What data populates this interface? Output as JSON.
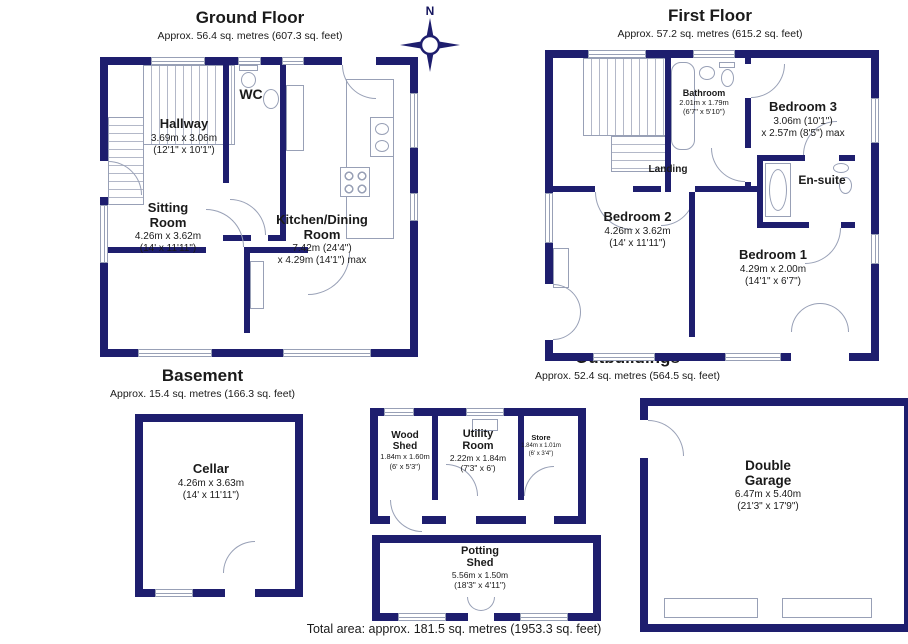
{
  "colors": {
    "wall": "#1e1e6e",
    "fixture": "#98a0b6",
    "text": "#1a1a1a"
  },
  "compass": {
    "label": "N"
  },
  "total_area": "Total area: approx. 181.5 sq. metres (1953.3 sq. feet)",
  "floors": {
    "ground": {
      "title": "Ground Floor",
      "subtitle": "Approx. 56.4 sq. metres (607.3 sq. feet)",
      "rooms": {
        "hallway": {
          "name": "Hallway",
          "metric": "3.69m x 3.06m",
          "imperial": "(12'1\" x 10'1\")"
        },
        "wc": {
          "name": "WC"
        },
        "sitting_room": {
          "name": "Sitting Room",
          "metric": "4.26m x 3.62m",
          "imperial": "(14' x 11'11\")"
        },
        "kitchen_dining": {
          "name": "Kitchen/Dining Room",
          "metric": "7.42m (24'4\")",
          "imperial": "x 4.29m (14'1\") max"
        }
      }
    },
    "first": {
      "title": "First Floor",
      "subtitle": "Approx. 57.2 sq. metres (615.2 sq. feet)",
      "rooms": {
        "bathroom": {
          "name": "Bathroom",
          "metric": "2.01m x 1.79m",
          "imperial": "(6'7\" x 5'10\")"
        },
        "bedroom3": {
          "name": "Bedroom 3",
          "metric": "3.06m (10'1\")",
          "imperial": "x 2.57m (8'5\") max"
        },
        "landing": {
          "name": "Landing"
        },
        "bedroom2": {
          "name": "Bedroom 2",
          "metric": "4.26m x 3.62m",
          "imperial": "(14' x 11'11\")"
        },
        "ensuite": {
          "name": "En-suite"
        },
        "bedroom1": {
          "name": "Bedroom 1",
          "metric": "4.29m x 2.00m",
          "imperial": "(14'1\" x 6'7\")"
        }
      }
    },
    "basement": {
      "title": "Basement",
      "subtitle": "Approx. 15.4 sq. metres (166.3 sq. feet)",
      "rooms": {
        "cellar": {
          "name": "Cellar",
          "metric": "4.26m x 3.63m",
          "imperial": "(14' x 11'11\")"
        }
      }
    },
    "outbuildings": {
      "title": "Outbuildings",
      "subtitle": "Approx. 52.4 sq. metres (564.5 sq. feet)",
      "rooms": {
        "wood_shed": {
          "name": "Wood Shed",
          "metric": "1.84m x 1.60m",
          "imperial": "(6' x 5'3\")"
        },
        "utility_room": {
          "name": "Utility Room",
          "metric": "2.22m x 1.84m",
          "imperial": "(7'3\" x 6')"
        },
        "store": {
          "name": "Store",
          "metric": "1.84m x 1.01m",
          "imperial": "(6' x 3'4\")"
        },
        "potting_shed": {
          "name": "Potting Shed",
          "metric": "5.56m x 1.50m",
          "imperial": "(18'3\" x 4'11\")"
        },
        "double_garage": {
          "name": "Double Garage",
          "metric": "6.47m x 5.40m",
          "imperial": "(21'3\" x 17'9\")"
        }
      }
    }
  }
}
